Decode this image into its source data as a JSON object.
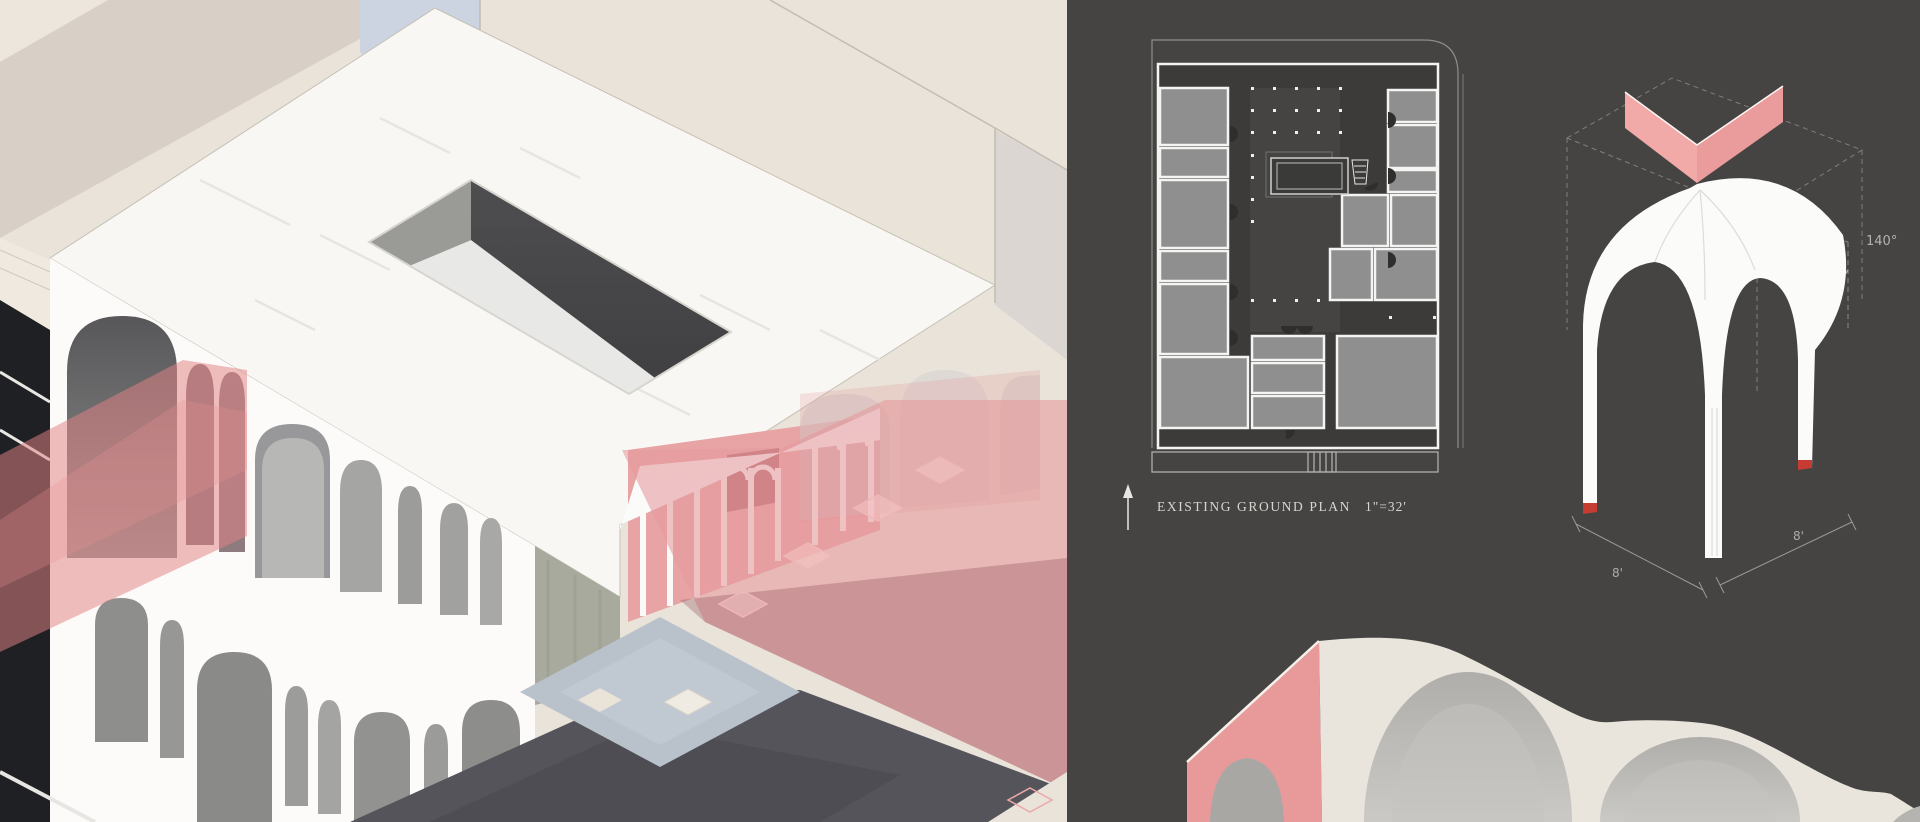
{
  "board": {
    "kind": "architecture presentation board",
    "accent_pink": "#eba9a9",
    "panel_dark": "#454442"
  },
  "left_panel": {
    "graphic": "sectional axonometric rendering of arched building with rooftop courtyard opening, pink light beams, colonnade, black ground plane and beige context blocks"
  },
  "right_panel": {
    "ground_plan": {
      "label": "EXISTING GROUND PLAN",
      "scale": "1\"=32'",
      "north_arrow_icon": "arrow-up"
    },
    "vault_detail": {
      "angle_label": "140°",
      "dimension_labels": [
        "8'",
        "8'"
      ],
      "marker_color": "#c63c33",
      "valley_color": "#f0a7a6"
    },
    "bottom_render": "vaulted bays detail with pink section cut face"
  },
  "colors": {
    "cream": "#e9e3d9",
    "beige_band": "#d8d0c6",
    "pale_blue": "#cbd4e0",
    "marble_white": "#f8f7f4",
    "sage_wall": "#a8aa9e",
    "black_ground": "#1c1c1e",
    "dark_ground": "#54545a",
    "plaza_blue_gray": "#b9c1cb",
    "plan_room_gray": "#8f8f8f"
  }
}
